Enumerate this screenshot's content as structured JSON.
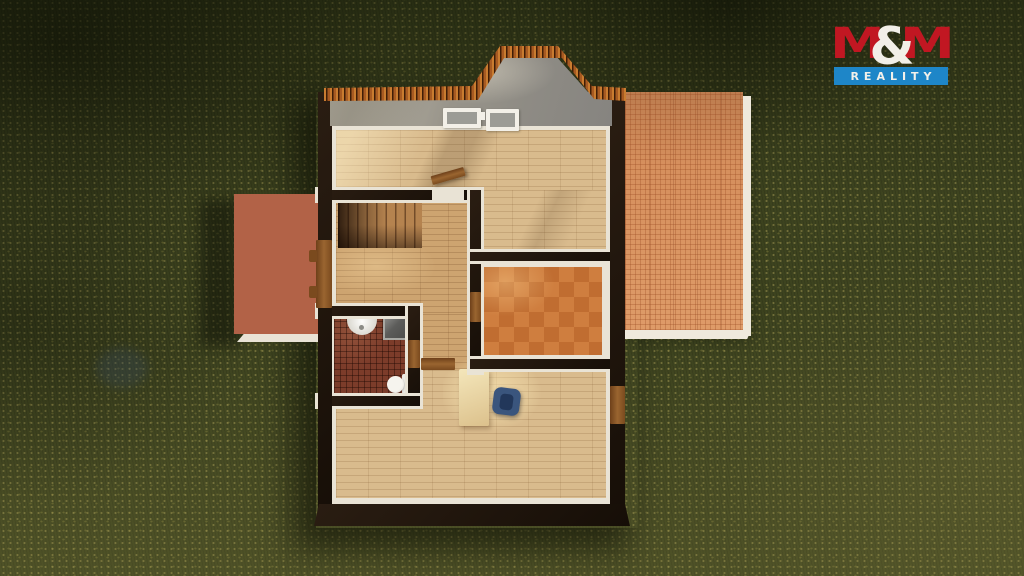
{
  "logo": {
    "m_left": "M",
    "ampersand": "&",
    "m_right": "M",
    "subtitle": "REALITY",
    "colors": {
      "red": "#c11722",
      "blue": "#1e86c8",
      "white": "#f2efe8"
    }
  },
  "scene": {
    "view": "top-down 3d render of attic floor plan",
    "setting": "green lawn with soft tree shadows",
    "features": [
      "red-brown tiled terrace on left",
      "large salmon tiled terrace on right",
      "roof tile fringe with central gable",
      "two white roof windows",
      "large parquet room at top",
      "hall with wooden staircase",
      "bathroom with washbasin, shower cabin and toilet",
      "orange checker-tiled room",
      "lower parquet room with desk and blue office chair",
      "wooden doors to terrace, rooms and right side"
    ],
    "palette": {
      "grass": "#3d431f",
      "wall": "#1d140c",
      "trim": "#e9e3d5",
      "parquet": "#d9bb8d",
      "hall_parquet": "#cda470",
      "orange_tile_a": "#cf7e3f",
      "orange_tile_b": "#c06d31",
      "bath_tile": "#7c3c2a",
      "terrace_left": "#b26247",
      "terrace_right": "#d78f5c",
      "roof_gray": "#96948e",
      "roof_tile": "#a75a22",
      "door": "#8a5526",
      "desk": "#ecd9a8",
      "chair": "#35517a"
    }
  }
}
